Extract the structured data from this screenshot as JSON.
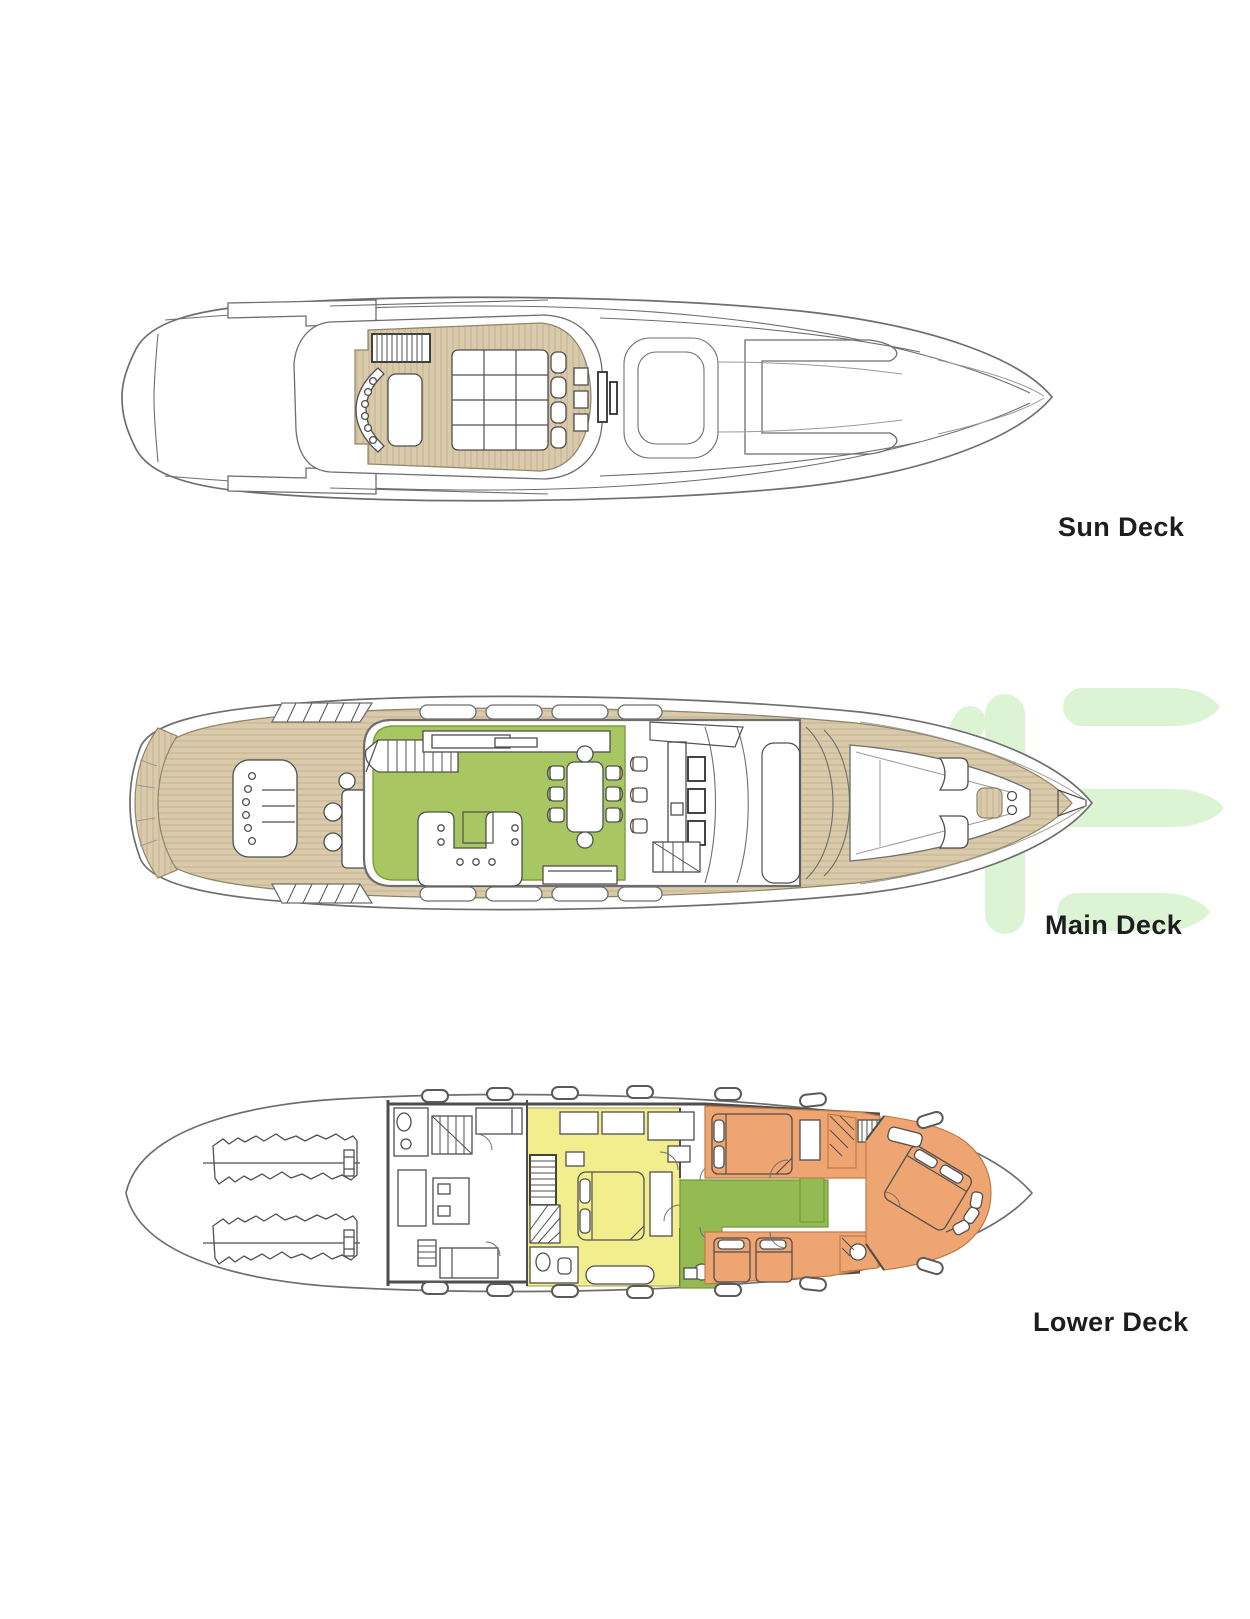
{
  "page": {
    "background": "#ffffff"
  },
  "labels": {
    "sun_deck": "Sun Deck",
    "main_deck": "Main Deck",
    "lower_deck": "Lower Deck"
  },
  "decks": [
    {
      "id": "sun-deck",
      "label": "Sun Deck"
    },
    {
      "id": "main-deck",
      "label": "Main Deck"
    },
    {
      "id": "lower-deck",
      "label": "Lower Deck"
    }
  ],
  "colors": {
    "label_text": "#1d1d1f",
    "outline": "#6e6e6e",
    "wall": "#4d4d4d",
    "teak": "#d8caaa",
    "teak_stripe": "#c3b28c",
    "salon_green": "#a8c763",
    "corridor_green": "#93bb52",
    "cabin_yellow": "#f2ee8e",
    "cabin_orange": "#efa571",
    "watermark_green": "#dcf4d3"
  }
}
